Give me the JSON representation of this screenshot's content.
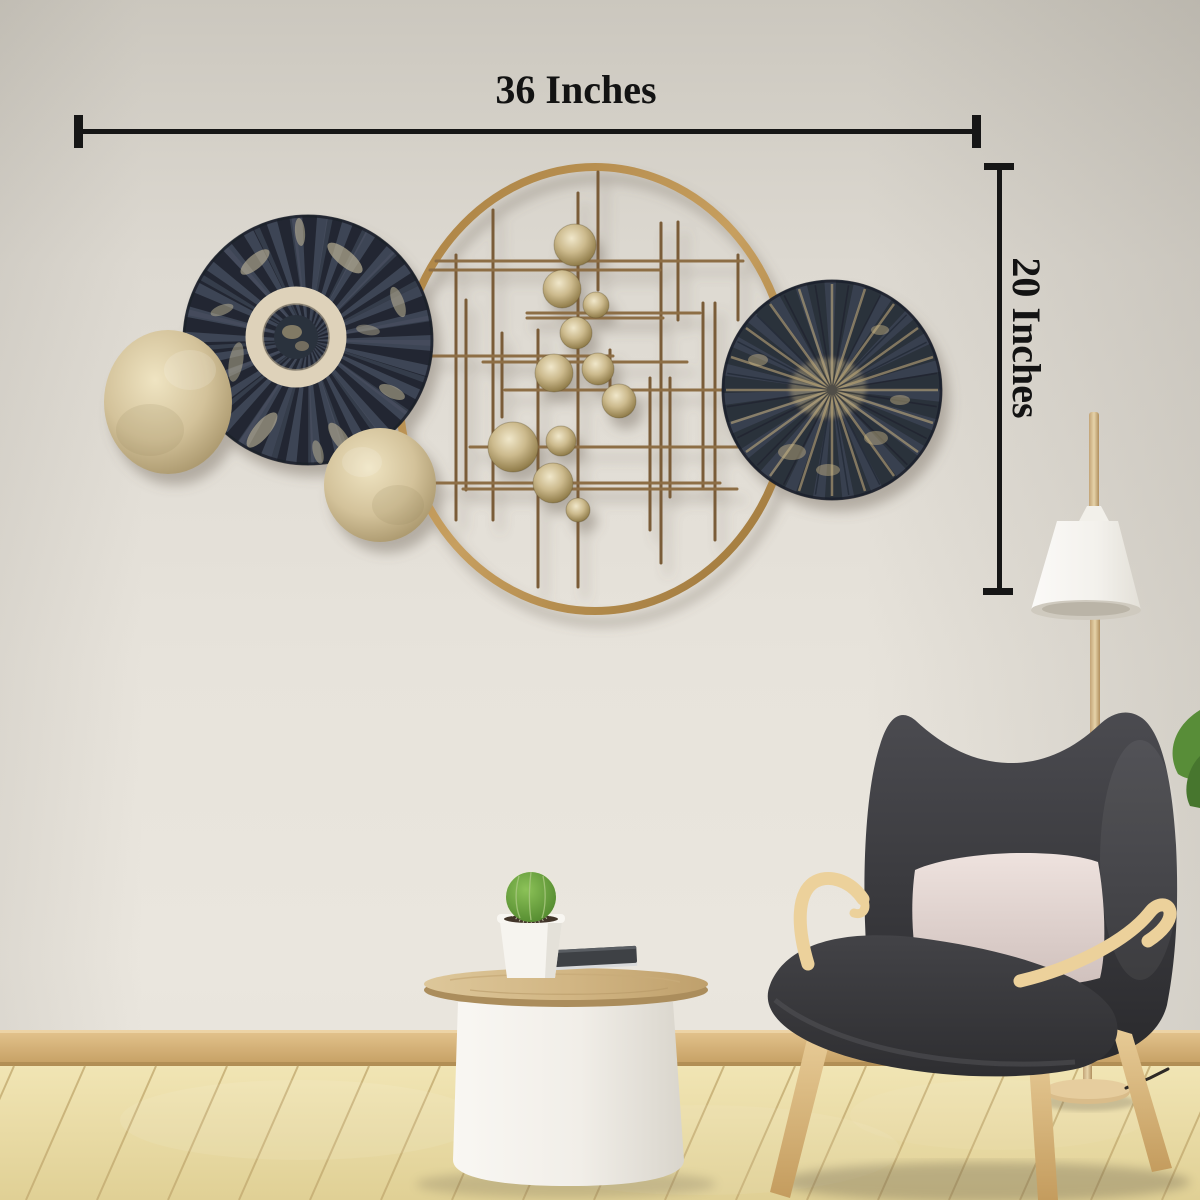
{
  "annotations": {
    "width_label": "36 Inches",
    "height_label": "20 Inches"
  },
  "palette": {
    "wall": "#e3dfd6",
    "dimension_marks": "#161616",
    "ring_gold": "#b9905a",
    "disc_navy": "#2b303b",
    "disc_champagne": "#d6c7a0",
    "rod_bronze": "#7a5c38",
    "sphere_brass": "#c7b588",
    "chair_fabric": "#39393c",
    "wood_accent": "#e2c28d",
    "pillow": "#e7dad6",
    "lamp_shade": "#f3f1ec",
    "table_white": "#f2efe9",
    "table_top_wood": "#d3b888",
    "cactus_green": "#69a33e",
    "floor_wood": "#ecdfab",
    "baseboard": "#d2ad74"
  }
}
